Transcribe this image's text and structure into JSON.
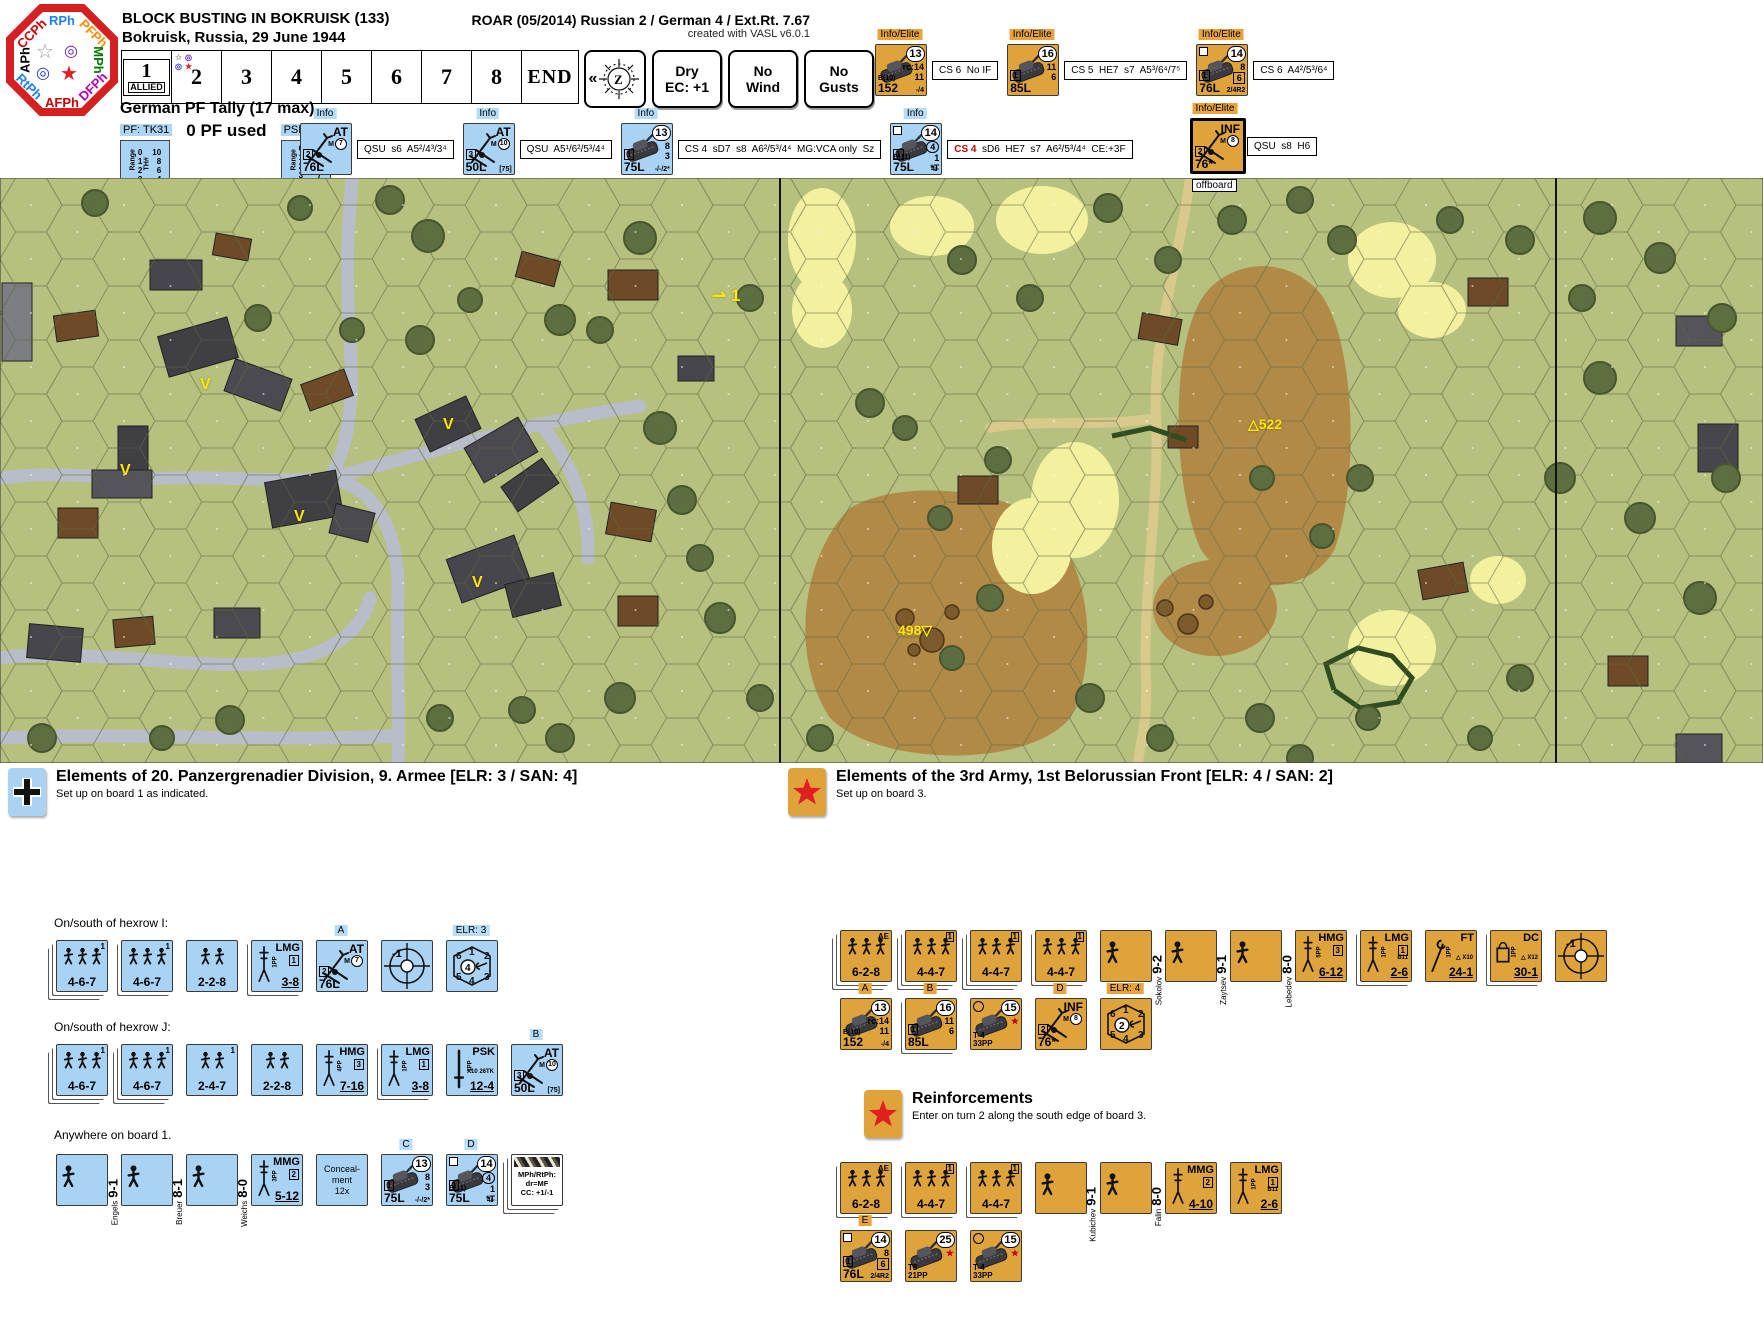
{
  "header": {
    "title1": "BLOCK BUSTING IN BOKRUISK (133)",
    "title2": "Bokruisk, Russia, 29 June 1944",
    "roar": "ROAR (05/2014) Russian 2 / German 4 / Ext.Rt. 7.67",
    "created": "created with VASL v6.0.1",
    "phases": [
      {
        "label": "RPh",
        "color": "#1e7fff",
        "pos": "n"
      },
      {
        "label": "PFPh",
        "color": "#ff8c00",
        "pos": "ne"
      },
      {
        "label": "MPh",
        "color": "#007a00",
        "pos": "e"
      },
      {
        "label": "DFPh",
        "color": "#b400b4",
        "pos": "se"
      },
      {
        "label": "AFPh",
        "color": "#cc0000",
        "pos": "s"
      },
      {
        "label": "RtPh",
        "color": "#1e7fff",
        "pos": "sw"
      },
      {
        "label": "APh",
        "color": "#000000",
        "pos": "w"
      },
      {
        "label": "CCPh",
        "color": "#cc0000",
        "pos": "nw"
      }
    ],
    "turn_cells": [
      "1",
      "2",
      "3",
      "4",
      "5",
      "6",
      "7",
      "8",
      "END"
    ],
    "turn1_sub": "ALLIED",
    "compass_prefix": "«",
    "weather_buttons": [
      [
        "Dry",
        "EC: +1"
      ],
      [
        "No",
        "Wind"
      ],
      [
        "No",
        "Gusts"
      ]
    ]
  },
  "pf_tally": {
    "title": "German PF Tally (17 max)",
    "pf_chip": "PF: TK31",
    "used": "0 PF used",
    "psk_chip": "PSK: TK26",
    "col1": "Range",
    "col2": "TH#",
    "pf_rows": [
      [
        "0",
        "10"
      ],
      [
        "1",
        "8"
      ],
      [
        "2",
        "6"
      ],
      [
        "3",
        "4"
      ]
    ],
    "psk_rows": [
      [
        "0",
        "11"
      ],
      [
        "1",
        "9"
      ],
      [
        "2",
        "8"
      ],
      [
        "3",
        "7"
      ],
      [
        "4",
        "4"
      ]
    ]
  },
  "header_counters": {
    "german": [
      {
        "label": "Info",
        "counter": {
          "t": "gun",
          "c": "b",
          "name": "AT",
          "mal": "M7",
          "box": "2",
          "cal": "76L"
        },
        "note": {
          "red": "",
          "text": "QSU  s6  A5²/4³/3⁴"
        }
      },
      {
        "label": "Info",
        "counter": {
          "t": "gun",
          "c": "b",
          "name": "AT",
          "mal": "M10",
          "box": "3",
          "cal": "50L",
          "extra": "[75]"
        },
        "note": {
          "red": "",
          "text": "QSU  A5¹/6²/5³/4⁴"
        }
      },
      {
        "label": "Info",
        "counter": {
          "t": "afv",
          "c": "b",
          "mp": "13",
          "sub": [
            "8",
            "3"
          ],
          "box": "1",
          "cal": "75L",
          "extra": "-/-/2*"
        },
        "note": {
          "red": "",
          "text": "CS 4  sD7  s8  A6²/5³/4⁴  MG:VCA only  Sz"
        }
      },
      {
        "label": "Info",
        "counter": {
          "t": "afv",
          "c": "b",
          "mp": "14",
          "sub": [
            "c:4",
            "1",
            "*T"
          ],
          "box": "1",
          "b": "B(11)",
          "cal": "75L",
          "extra": "4/-",
          "sq": true
        },
        "note": {
          "red": "CS 4",
          "text": "  sD6  HE7  s7  A6²/5³/4⁴  CE:+3F"
        }
      }
    ],
    "russian": [
      {
        "label": "Info/Elite",
        "counter": {
          "t": "afv",
          "c": "o",
          "mp": "13",
          "sub": [
            "rc:14",
            "11"
          ],
          "b": "B(10)",
          "cal": "152",
          "extra": "-/4"
        },
        "note": {
          "red": "",
          "text": "CS 6  No IF"
        }
      },
      {
        "label": "Info/Elite",
        "counter": {
          "t": "afv",
          "c": "o",
          "mp": "16",
          "sub": [
            "11",
            "6"
          ],
          "box": "1",
          "cal": "85L"
        },
        "note": {
          "red": "",
          "text": "CS 5  HE7  s7  A5³/6⁴/7⁵"
        }
      },
      {
        "label": "Info/Elite",
        "counter": {
          "t": "afv",
          "c": "o",
          "mp": "14",
          "sub": [
            "8",
            "b:6"
          ],
          "box": "1",
          "cal": "76L",
          "extra": "2/4R2",
          "sq": true
        },
        "note": {
          "red": "",
          "text": "CS 6  A4²/5³/6⁴"
        }
      }
    ],
    "offboard_gun": [
      {
        "label": "Info/Elite",
        "counter": {
          "t": "gun",
          "c": "o",
          "name": "INF",
          "mal": "M8",
          "box": "2",
          "cal": "76*",
          "thick": true
        },
        "note": {
          "red": "",
          "text": "QSU  s8  H6"
        }
      }
    ]
  },
  "map": {
    "offboard": "offboard",
    "hill_labels": [
      {
        "text": "△522",
        "x": 1248,
        "y": 238
      },
      {
        "text": "498▽",
        "x": 898,
        "y": 444
      }
    ],
    "v_markers": [
      {
        "x": 200,
        "y": 198
      },
      {
        "x": 120,
        "y": 284
      },
      {
        "x": 294,
        "y": 330
      },
      {
        "x": 472,
        "y": 396
      },
      {
        "x": 443,
        "y": 238
      }
    ],
    "turn_marker": {
      "text": "⇀ 1",
      "x": 712,
      "y": 108
    }
  },
  "german_panel": {
    "title": "Elements of 20. Panzergrenadier Division, 9. Armee [ELR: 3 / SAN: 4]",
    "subtitle": "Set up on board 1 as indicated.",
    "groups": [
      {
        "header": "On/south of hexrow I:",
        "counters": [
          {
            "t": "squad",
            "c": "b",
            "main": "4-6-7",
            "sup": "1",
            "figs": 3,
            "st": 2
          },
          {
            "t": "squad",
            "c": "b",
            "main": "4-6-7",
            "sup": "1",
            "figs": 3,
            "st": 1
          },
          {
            "t": "squad",
            "c": "b",
            "main": "2-2-8",
            "figs": 2
          },
          {
            "t": "sw",
            "c": "b",
            "name": "LMG",
            "num": "3-8",
            "pp": "1PP",
            "box": "1",
            "st": 1
          },
          {
            "t": "gun",
            "c": "b",
            "above": "A",
            "name": "AT",
            "mal": "M7",
            "box": "2",
            "cal": "76L"
          },
          {
            "t": "acq",
            "c": "b",
            "val": "-1"
          },
          {
            "t": "sniper",
            "c": "b",
            "above": "ELR: 3",
            "san": "4"
          }
        ]
      },
      {
        "header": "On/south of hexrow J:",
        "counters": [
          {
            "t": "squad",
            "c": "b",
            "main": "4-6-7",
            "sup": "1",
            "figs": 3,
            "st": 2
          },
          {
            "t": "squad",
            "c": "b",
            "main": "4-6-7",
            "sup": "1",
            "figs": 3,
            "st": 2
          },
          {
            "t": "squad",
            "c": "b",
            "main": "2-4-7",
            "sup": "1",
            "figs": 2
          },
          {
            "t": "squad",
            "c": "b",
            "main": "2-2-8",
            "figs": 2
          },
          {
            "t": "sw",
            "c": "b",
            "name": "HMG",
            "num": "7-16",
            "pp": "4PP",
            "box": "3"
          },
          {
            "t": "sw",
            "c": "b",
            "name": "LMG",
            "num": "3-8",
            "pp": "1PP",
            "box": "1",
            "st": 1
          },
          {
            "t": "sw",
            "c": "b",
            "name": "PSK",
            "num": "12-4",
            "pp": "1PP",
            "extra": "X10 26TK"
          },
          {
            "t": "gun",
            "c": "b",
            "above": "B",
            "name": "AT",
            "mal": "M10",
            "box": "3",
            "cal": "50L",
            "extra": "[75]"
          }
        ]
      },
      {
        "header": "Anywhere on board 1.",
        "counters": [
          {
            "t": "leader",
            "c": "b",
            "name": "Engels",
            "num": "9-1"
          },
          {
            "t": "leader",
            "c": "b",
            "name": "Breuer",
            "num": "8-1"
          },
          {
            "t": "leader",
            "c": "b",
            "name": "Weichs",
            "num": "8-0"
          },
          {
            "t": "sw",
            "c": "b",
            "name": "MMG",
            "num": "5-12",
            "pp": "3PP",
            "box": "2"
          },
          {
            "t": "text",
            "c": "b",
            "lines": [
              "Conceal-",
              "ment",
              "12x"
            ]
          },
          {
            "t": "afv",
            "c": "b",
            "above": "C",
            "mp": "13",
            "sub": [
              "8",
              "3"
            ],
            "box": "1",
            "cal": "75L",
            "extra": "-/-/2*"
          },
          {
            "t": "afv",
            "c": "b",
            "above": "D",
            "mp": "14",
            "sub": [
              "c:4",
              "1",
              "*T"
            ],
            "box": "1",
            "b": "B(11)",
            "cal": "75L",
            "extra": "4/-",
            "sq": true
          },
          {
            "t": "note",
            "c": "w",
            "lines": [
              "MPh/RtPh:",
              "dr=MF",
              "CC: +1/-1"
            ],
            "st": 2
          }
        ]
      }
    ]
  },
  "russian_panel": {
    "title": "Elements of the 3rd Army, 1st Belorussian Front [ELR: 4 / SAN: 2]",
    "subtitle": "Set up on board 3.",
    "row1": [
      {
        "t": "squad",
        "c": "o",
        "main": "6-2-8",
        "tag": "AE",
        "figs": 3,
        "st": 2
      },
      {
        "t": "squad",
        "c": "o",
        "main": "4-4-7",
        "boxtag": "1",
        "figs": 3,
        "st": 2
      },
      {
        "t": "squad",
        "c": "o",
        "main": "4-4-7",
        "boxtag": "1",
        "figs": 3,
        "st": 2
      },
      {
        "t": "squad",
        "c": "o",
        "main": "4-4-7",
        "boxtag": "1",
        "figs": 3,
        "st": 1
      },
      {
        "t": "leader",
        "c": "o",
        "name": "Sokolov",
        "num": "9-2"
      },
      {
        "t": "leader",
        "c": "o",
        "name": "Zaytsev",
        "num": "9-1"
      },
      {
        "t": "leader",
        "c": "o",
        "name": "Lebedev",
        "num": "8-0"
      },
      {
        "t": "sw",
        "c": "o",
        "name": "HMG",
        "num": "6-12",
        "pp": "5PP",
        "box": "3"
      },
      {
        "t": "sw",
        "c": "o",
        "name": "LMG",
        "num": "2-6",
        "pp": "1PP",
        "box": "1",
        "extra": "B11",
        "st": 1
      },
      {
        "t": "sw",
        "c": "o",
        "name": "FT",
        "num": "24-1",
        "pp": "1PP",
        "extra": "△ X10"
      },
      {
        "t": "sw",
        "c": "o",
        "name": "DC",
        "num": "30-1",
        "pp": "1PP",
        "extra": "△ X12",
        "st": 1
      },
      {
        "t": "acq",
        "c": "o",
        "val": "-1"
      }
    ],
    "row2": [
      {
        "t": "afv",
        "c": "o",
        "above": "A",
        "mp": "13",
        "sub": [
          "rc:14",
          "11"
        ],
        "b": "B(10)",
        "cal": "152",
        "extra": "-/4"
      },
      {
        "t": "afv",
        "c": "o",
        "above": "B",
        "mp": "16",
        "sub": [
          "11",
          "6"
        ],
        "box": "1",
        "cal": "85L",
        "st": 1
      },
      {
        "t": "afv",
        "c": "o",
        "mp": "15",
        "sub": [
          "r:★"
        ],
        "circ": true,
        "cal": "T-4",
        "cal2": "33PP"
      },
      {
        "t": "gun",
        "c": "o",
        "above": "D",
        "name": "INF",
        "mal": "M8",
        "box": "2",
        "cal": "76*"
      },
      {
        "t": "sniper",
        "c": "o",
        "above": "ELR: 4",
        "san": "2"
      }
    ],
    "reinforcements": {
      "title": "Reinforcements",
      "subtitle": "Enter on turn 2 along the south edge of board 3.",
      "row1": [
        {
          "t": "squad",
          "c": "o",
          "main": "6-2-8",
          "tag": "AE",
          "figs": 3,
          "st": 1
        },
        {
          "t": "squad",
          "c": "o",
          "main": "4-4-7",
          "boxtag": "1",
          "figs": 3,
          "st": 1
        },
        {
          "t": "squad",
          "c": "o",
          "main": "4-4-7",
          "boxtag": "1",
          "figs": 3,
          "st": 1
        },
        {
          "t": "leader",
          "c": "o",
          "name": "Kubichev",
          "num": "9-1"
        },
        {
          "t": "leader",
          "c": "o",
          "name": "Falin",
          "num": "8-0"
        },
        {
          "t": "sw",
          "c": "o",
          "name": "MMG",
          "num": "4-10",
          "box": "2"
        },
        {
          "t": "sw",
          "c": "o",
          "name": "LMG",
          "num": "2-6",
          "pp": "1PP",
          "box": "1",
          "extra": "B11"
        }
      ],
      "row2": [
        {
          "t": "afv",
          "c": "o",
          "above": "E",
          "mp": "14",
          "sub": [
            "8",
            "b:6"
          ],
          "box": "1",
          "cal": "76L",
          "extra": "2/4R2",
          "sq": true
        },
        {
          "t": "afv",
          "c": "o",
          "mp": "25",
          "sub": [
            "r:★"
          ],
          "cal": "T8",
          "cal2": "21PP"
        },
        {
          "t": "afv",
          "c": "o",
          "mp": "15",
          "sub": [
            "r:★"
          ],
          "circ": true,
          "cal": "T-4",
          "cal2": "33PP"
        }
      ]
    }
  }
}
